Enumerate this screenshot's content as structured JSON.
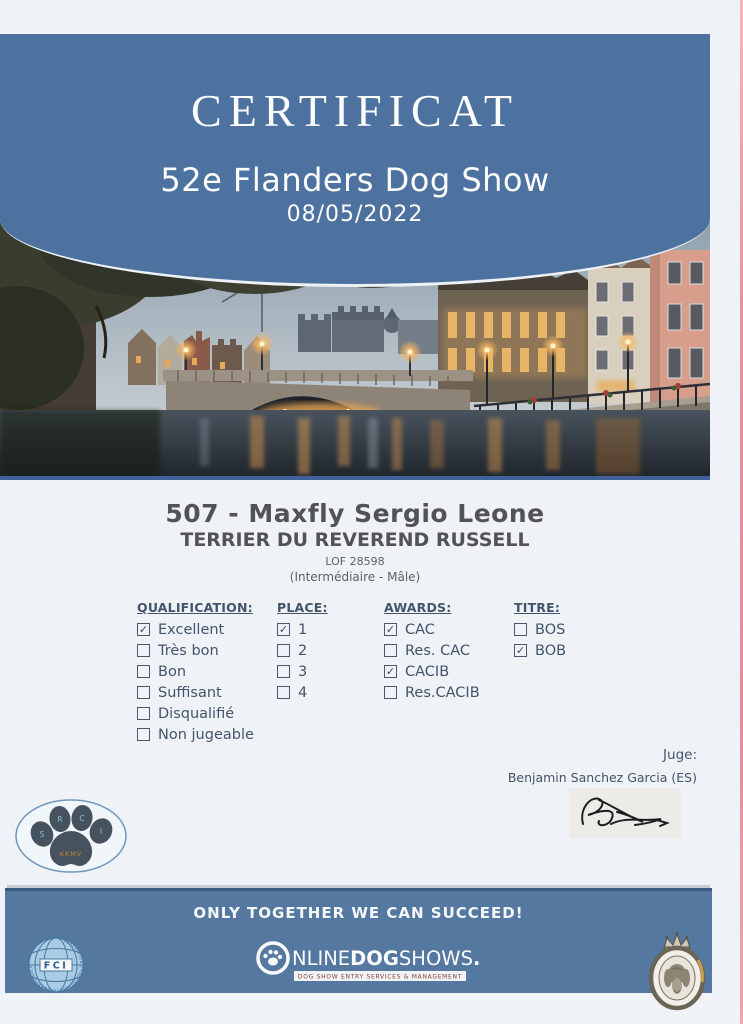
{
  "header": {
    "title": "CERTIFICAT",
    "show_name": "52e Flanders Dog Show",
    "date": "08/05/2022"
  },
  "entry": {
    "number_name": "507 - Maxfly Sergio Leone",
    "breed": "TERRIER DU REVEREND RUSSELL",
    "pedigree": "LOF 28598",
    "class_sex": "(Intermédiaire - Mâle)"
  },
  "sections": [
    {
      "title": "QUALIFICATION:",
      "items": [
        {
          "label": "Excellent",
          "checked": true
        },
        {
          "label": "Très bon",
          "checked": false
        },
        {
          "label": "Bon",
          "checked": false
        },
        {
          "label": "Suffisant",
          "checked": false
        },
        {
          "label": "Disqualifié",
          "checked": false
        },
        {
          "label": "Non jugeable",
          "checked": false
        }
      ]
    },
    {
      "title": "PLACE:",
      "items": [
        {
          "label": "1",
          "checked": true
        },
        {
          "label": "2",
          "checked": false
        },
        {
          "label": "3",
          "checked": false
        },
        {
          "label": "4",
          "checked": false
        }
      ]
    },
    {
      "title": "AWARDS:",
      "items": [
        {
          "label": "CAC",
          "checked": true
        },
        {
          "label": "Res. CAC",
          "checked": false
        },
        {
          "label": "CACIB",
          "checked": true
        },
        {
          "label": "Res.CACIB",
          "checked": false
        }
      ]
    },
    {
      "title": "TITRE:",
      "items": [
        {
          "label": "BOS",
          "checked": false
        },
        {
          "label": "BOB",
          "checked": true
        }
      ]
    }
  ],
  "judge": {
    "label": "Juge:",
    "name": "Benjamin Sanchez Garcia (ES)"
  },
  "band": {
    "motto": "ONLY TOGETHER WE CAN SUCCEED!"
  },
  "logos": {
    "fci": {
      "text": "FCI",
      "ring_text": "FEDERATION CYNOLOGIQUE INTERNATIONALE"
    },
    "ods": {
      "online": "NLINE",
      "dog": "DOG",
      "shows": "SHOWS",
      "eu": ".eu",
      "tagline": "DOG SHOW ENTRY SERVICES & MANAGEMENT"
    },
    "paw": {
      "toe_letters": [
        "S",
        "R",
        "C",
        "I"
      ],
      "pad_text": "KKMV"
    }
  },
  "icons": {
    "checked_glyph": "✓"
  },
  "colors": {
    "header_blue": "#4d72a0",
    "band_blue": "#54789f",
    "text_slate": "#42546a",
    "text_gray": "#515356",
    "underline_navy": "#41619b"
  }
}
